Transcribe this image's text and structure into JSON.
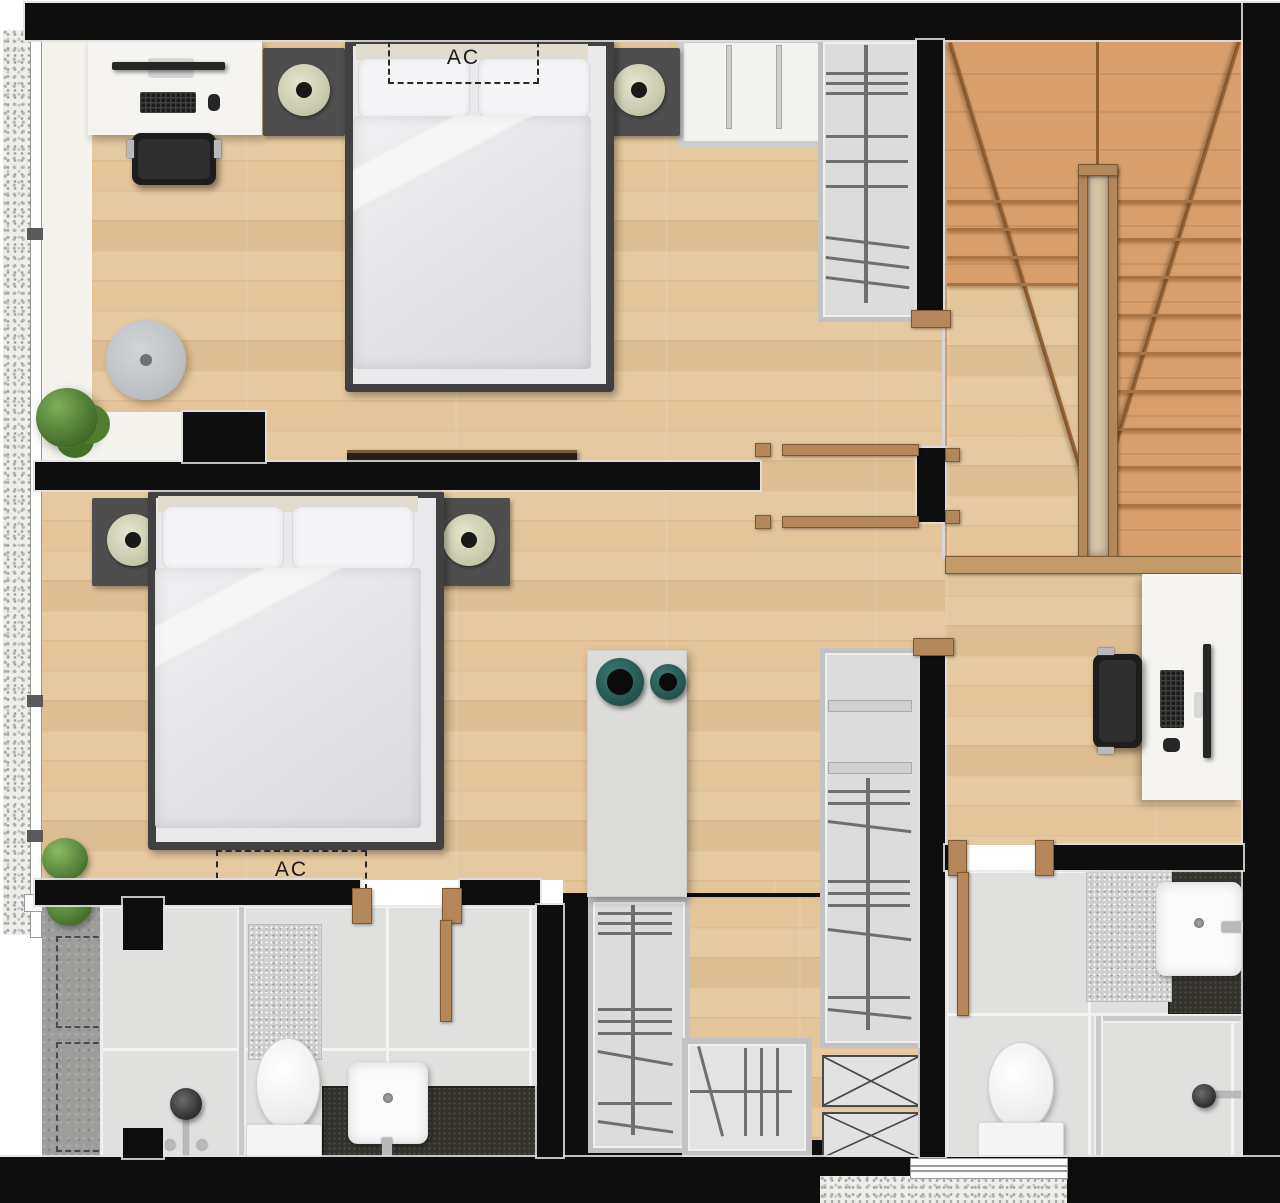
{
  "page": {
    "type": "floor-plan-render",
    "width_px": 1280,
    "height_px": 1203
  },
  "labels": {
    "ac1": "AC",
    "ac2": "AC"
  },
  "colors": {
    "wall": "#0e0e0e",
    "wood": "#e5c9a0",
    "stair": "#d89f6c",
    "tile": "#e0e0df",
    "doorwood": "#b3875a",
    "concrete": "#9d9d9b",
    "speaker_ring": "#c9c9ae",
    "bowl_teal": "#275752",
    "counter_dark": "#34322c",
    "plant_green": "#4e7a33"
  },
  "rooms": [
    {
      "name": "bedroom-1",
      "furniture": [
        "double-bed",
        "two-pillows",
        "two-nightstands-with-speakers",
        "desk-with-monitor-keyboard-mouse",
        "office-chair",
        "round-rug",
        "wall-tv",
        "white-shelf-unit",
        "wardrobe",
        "ac-unit-dashed-label"
      ]
    },
    {
      "name": "bedroom-2",
      "furniture": [
        "double-bed",
        "two-pillows",
        "two-nightstands-with-speakers",
        "console-with-two-teal-bowls",
        "wall-tv",
        "ac-unit-dashed-label"
      ]
    },
    {
      "name": "hall",
      "furniture": [
        "u-shaped-staircase-with-winders",
        "center-handrail",
        "desk-with-monitor-keyboard-mouse",
        "office-chair"
      ]
    },
    {
      "name": "walk-in-closet",
      "furniture": [
        "tall-wardrobe-left",
        "hatched-cabinet",
        "tall-wardrobe-right",
        "two-crossed-duct-shafts"
      ]
    },
    {
      "name": "bathroom-1",
      "furniture": [
        "shower-fixture",
        "glass-partition",
        "bath-mat",
        "toilet",
        "sink-on-dark-counter",
        "swing-door"
      ]
    },
    {
      "name": "bathroom-2",
      "furniture": [
        "sink-on-dark-counter",
        "bath-mat",
        "toilet",
        "glass-shower-enclosure",
        "shower-fixture",
        "swing-door",
        "window"
      ]
    },
    {
      "name": "balcony-strip",
      "furniture": [
        "large-plant",
        "two-small-plants",
        "full-height-window"
      ]
    },
    {
      "name": "service-area",
      "furniture": [
        "two-dashed-condenser-outlines",
        "window-to-shower"
      ]
    }
  ]
}
